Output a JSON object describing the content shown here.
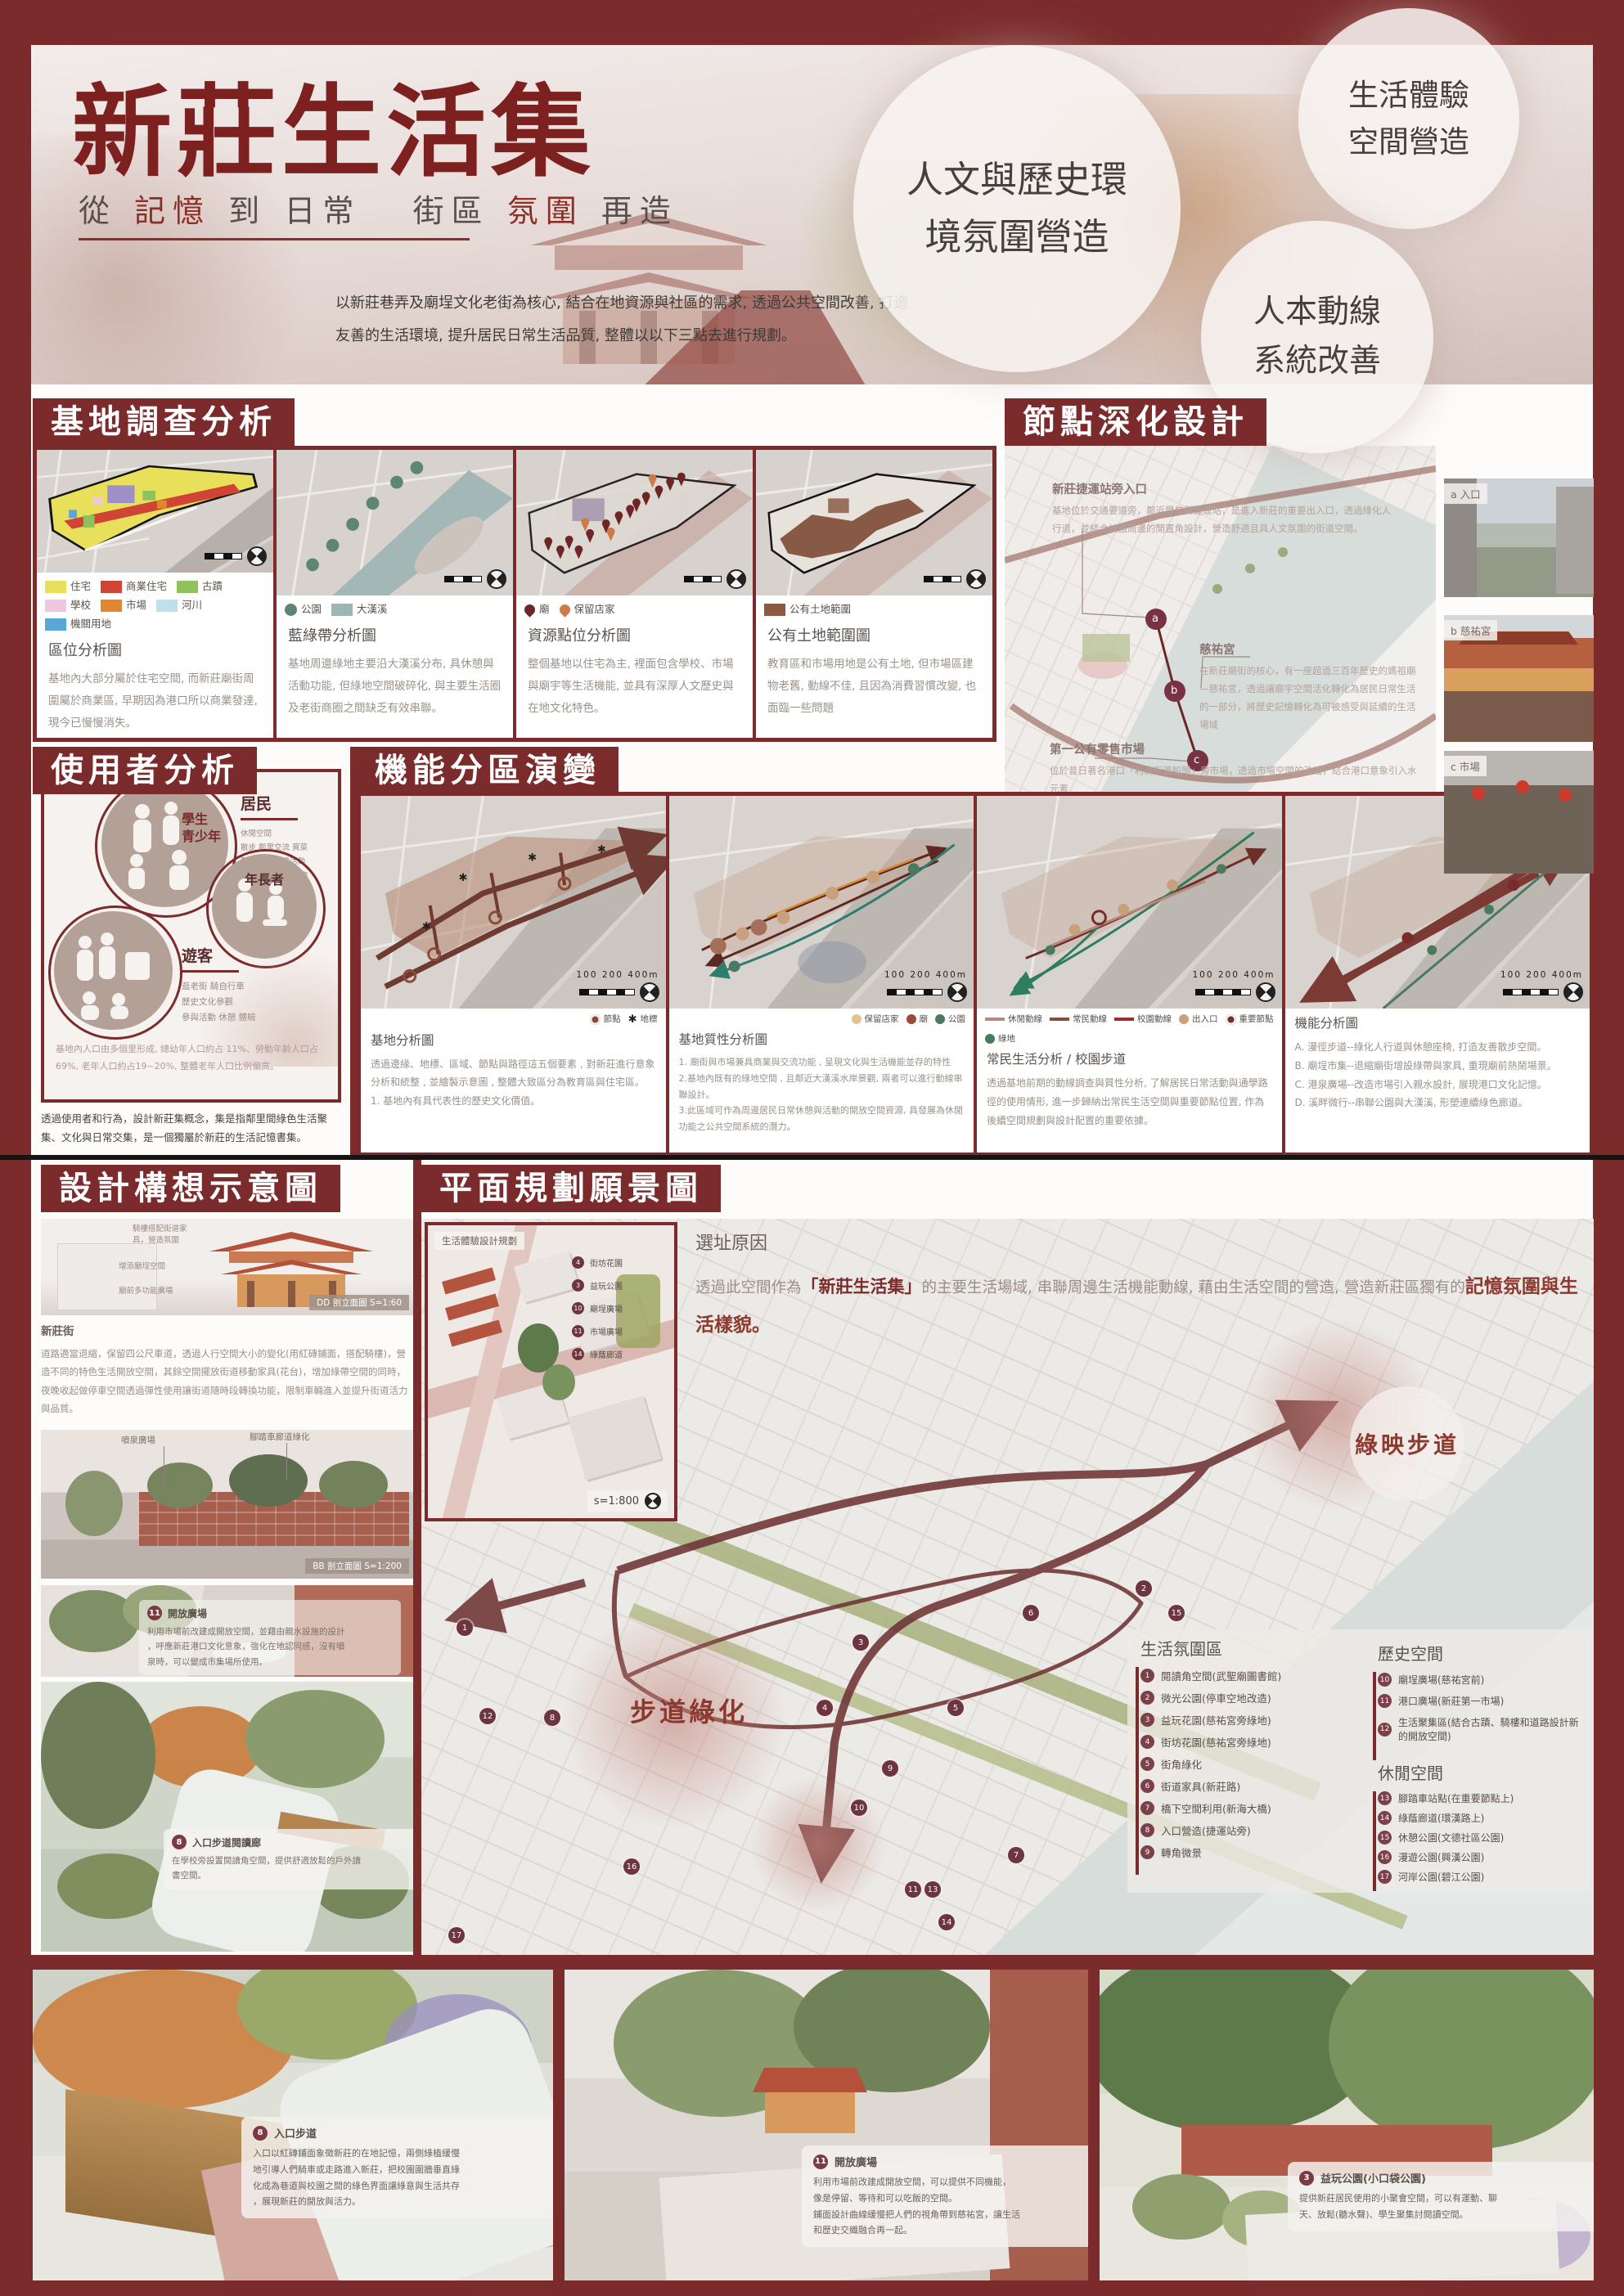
{
  "colors": {
    "frame_maroon": "#7b2b2b",
    "title_red": "#7c2020",
    "accent_red": "#8c3a30"
  },
  "header": {
    "title": "新莊生活集",
    "subtitle": {
      "p0": "從",
      "p1": "記憶",
      "p2": "到",
      "p3": "日常",
      "p4": "街區",
      "p5": "氛圍",
      "p6": "再造"
    },
    "intro": "以新莊巷弄及廟埕文化老街為核心, 結合在地資源與社區的需求, 透過公共空間改善, 打造\n友善的生活環境, 提升居民日常生活品質, 整體以以下三點去進行規劃。",
    "badges": {
      "b1": "人文與歷史環\n境氛圍營造",
      "b2": "生活體驗\n空間營造",
      "b3": "人本動線\n系統改善"
    }
  },
  "site_survey": {
    "title": "基地調查分析",
    "maps": [
      {
        "name": "區位分析圖",
        "caption": "基地內大部分屬於住宅空間, 而新莊廟街周圍屬於商業區, 早期因為港口所以商業發達, 現今已慢慢消失。",
        "legend": [
          {
            "label": "住宅",
            "color": "#e8e05a"
          },
          {
            "label": "商業住宅",
            "color": "#cf4434"
          },
          {
            "label": "古蹟",
            "color": "#8fc25c"
          },
          {
            "label": "學校",
            "color": "#ecc7de"
          },
          {
            "label": "市場",
            "color": "#e2862f"
          },
          {
            "label": "河川",
            "color": "#bfe0e8"
          },
          {
            "label": "機關用地",
            "color": "#57a8d8"
          }
        ]
      },
      {
        "name": "藍綠帶分析圖",
        "caption": "基地周邊綠地主要沿大漢溪分布, 具休憩與活動功能, 但綠地空間破碎化, 與主要生活圈及老街商圈之間缺乏有效串聯。",
        "legend": [
          {
            "label": "公園",
            "color": "#5e8672"
          },
          {
            "label": "大漢溪",
            "color": "#9fb5b3"
          }
        ]
      },
      {
        "name": "資源點位分析圖",
        "caption": "整個基地以住宅為主, 裡面包含學校、市場與廟宇等生活機能, 並具有深厚人文歷史與在地文化特色。",
        "legend": [
          {
            "label": "廟",
            "color": "#6e2525"
          },
          {
            "label": "保留店家",
            "color": "#cf7a4a"
          }
        ]
      },
      {
        "name": "公有土地範圍圖",
        "caption": "教育區和市場用地是公有土地, 但市場區建物老舊, 動線不佳, 且因為消費習慣改變, 也面臨一些問題",
        "legend": [
          {
            "label": "公有土地範圍",
            "color": "#8a5a41"
          }
        ]
      }
    ]
  },
  "node_design": {
    "title": "節點深化設計",
    "annotations": [
      {
        "heading": "新莊捷運站旁入口",
        "body": "基地位於交通要道旁，鄰近學校與捷運站，是進入新莊的重要出入口，透過綠化人\n行道，並結合校園周邊的閒置角設計，營造舒適且具人文氛圍的街道空間。"
      },
      {
        "heading": "慈祐宮",
        "body": "在新莊廟街的核心，有一座超過三百年歷史的媽祖廟—慈祐宮，透過讓廟宇空間活化轉化為居民日常生活的一部分，將歷史記憶轉化為可被感受與延續的生活場域"
      },
      {
        "heading": "第一公有零售市場",
        "body": "位於昔日著名港口「利濟街渡船頭」旁市場，透過市場空間的改造，結合港口意象引入水元素\n設計親水階梯，使廟前至市場廣場之間形成一個連續的生活聚集軸帶。"
      }
    ],
    "route_nodes": [
      "a",
      "b",
      "c"
    ],
    "photos": [
      {
        "label": "a 入口"
      },
      {
        "label": "b 慈祐宮"
      },
      {
        "label": "c 市場"
      }
    ]
  },
  "user_analysis": {
    "title": "使用者分析",
    "resident": {
      "name": "居民",
      "lines": "休閒空間\n散步 鄰里交流 買菜\n聚集空間 日常活動\n休憩 騎腳踏車 購物\n在地回憶"
    },
    "students": "學生\n青少年",
    "elder": "年長者",
    "visitor": {
      "name": "遊客",
      "lines": "逛老街 騎自行車\n歷史文化參觀\n參與活動 休憩 體驗"
    },
    "stats": "基地內人口由多個里形成, 總幼年人口約占 11%、勞動年齡人口占69%, 老年人口約占19~20%, 整體老年人口比例偏高。",
    "concept": "透過使用者和行為，設計新莊集概念，集是指鄰里間綠色生活聚集、文化與日常交集，是一個獨屬於新莊的生活記憶書集。"
  },
  "zoning": {
    "title": "機能分區演變",
    "maps": [
      {
        "name": "基地分析圖",
        "scale": "100  200      400m",
        "caption": "透過邊緣、地標、區域、節點與路徑這五個要素 , 對新莊進行意象分析和統整 , 並繪製示意圖 , 整體大致區分為教育區與住宅區。\n1. 基地內有具代表性的歷史文化價值。",
        "legend": [
          {
            "label": "節點",
            "type": "ring",
            "color": "#8a4a3a"
          },
          {
            "label": "地標",
            "type": "star",
            "color": "#222222"
          }
        ]
      },
      {
        "name": "基地質性分析圖",
        "scale": "100  200      400m",
        "caption": "1. 廟街與市場兼具商業與交流功能 , 呈現文化與生活機能並存的特性\n2.基地內既有的綠地空間 , 且鄰近大漢溪水岸景觀, 兩者可以進行動線串聯設計。\n3.此區域可作為周邊居民日常休憩與活動的開放空間資源, 具發展為休閒功能之公共空間系統的潛力。",
        "legend": [
          {
            "label": "保留店家",
            "type": "dot",
            "color": "#e3c48e"
          },
          {
            "label": "廟",
            "type": "dot",
            "color": "#9c4a3a"
          },
          {
            "label": "公園",
            "type": "dot",
            "color": "#4a7a5e"
          }
        ]
      },
      {
        "name": "常民生活分析 / 校園步道",
        "scale": "100  200      400m",
        "caption": "透過基地前期的動線調查與質性分析, 了解居民日常活動與通學路徑的使用情形, 進一步歸納出常民生活空間與重要節點位置, 作為後續空間規劃與設計配置的重要依據。",
        "legend": [
          {
            "label": "休閒動線",
            "type": "line",
            "color": "#b58a7a"
          },
          {
            "label": "常民動線",
            "type": "line",
            "color": "#8a4a3a"
          },
          {
            "label": "校園動線",
            "type": "line",
            "color": "#9c2f2a"
          },
          {
            "label": "出入口",
            "type": "dot",
            "color": "#c8a07e"
          },
          {
            "label": "重要節點",
            "type": "ring",
            "color": "#7b2b2b"
          },
          {
            "label": "綠地",
            "type": "dot",
            "color": "#4a7a5e"
          }
        ]
      },
      {
        "name": "機能分析圖",
        "scale": "100  200      400m",
        "caption": "A. 漫徑步道--綠化人行道與休憩座椅, 打造友善散步空間。\nB. 廟埕市集--退縮廟街增設綠帶與家具, 重現廟前熱鬧場景。\nC. 港泉廣場--改造市場引入親水設計, 展現港口文化記憶。\nD. 溪畔微行--串聯公園與大漢溪, 形塑連續綠色廊道。",
        "legend": []
      }
    ]
  },
  "design_concepts": {
    "title": "設計構想示意圖",
    "elevation": {
      "ann1": "騎樓搭配街道家\n具，營造氛圍",
      "ann2": "增添廟埕空間",
      "ann3": "廟前多功能廣場",
      "tag": "DD 剖立面圖 S=1:60"
    },
    "street": {
      "heading": "新莊街",
      "body": "道路適當退縮，保留四公尺車道，透過人行空間大小的變化(用紅磚鋪面，搭配騎樓)，營造不同的特色生活開放空間，其餘空間擺放街道移動家具(花台)，增加綠帶空間的同時，夜晚收起做停車空間透過彈性使用讓街道隨時段轉換功能，限制車輛進入並提升街道活力與品質。"
    },
    "section_bb": {
      "ann1": "噴泉廣場",
      "ann2": "腳踏車廊道綠化",
      "tag": "BB 剖立面圖 S=1:200"
    },
    "plaza": {
      "num": "11",
      "heading": "開放廣場",
      "body": "利用市場前改建成開放空間，並藉由親水設施的設計\n，呼應新莊港口文化意象，強化在地認同感，沒有噴\n泉時，可以變成市集場所使用。"
    },
    "entry": {
      "num": "8",
      "heading": "入口步道閱讀廊",
      "body": "在學校旁設置閱讀角空間，提供舒適放鬆的戶外讀\n書空間。"
    }
  },
  "master_plan": {
    "title": "平面規劃願景圖",
    "inset": {
      "title": "生活體驗設計規劃",
      "scale": "s=1:800",
      "items": [
        {
          "num": "4",
          "label": "街坊花園"
        },
        {
          "num": "3",
          "label": "益玩公園"
        },
        {
          "num": "10",
          "label": "廟埕廣場"
        },
        {
          "num": "11",
          "label": "市場廣場"
        },
        {
          "num": "14",
          "label": "綠蔭廊道"
        }
      ]
    },
    "reason": {
      "title": "選址原因",
      "seg1": "透過此空間作為",
      "brand": "「新莊生活集」",
      "seg2": "的主要生活場域, 串聯周邊生活機能動線, 藉由生活空間的營造, 營造新莊區獨有的",
      "strong": "記憶氛圍與生活樣貌。"
    },
    "labels": {
      "walkway": "步道綠化",
      "greenway": "綠映步道"
    },
    "legend": {
      "life": {
        "title": "生活氛圍區",
        "items": [
          {
            "num": "1",
            "label": "閱讀角空間(武聖廟圖書館)"
          },
          {
            "num": "2",
            "label": "微光公園(停車空地改造)"
          },
          {
            "num": "3",
            "label": "益玩花園(慈祐宮旁綠地)"
          },
          {
            "num": "4",
            "label": "街坊花園(慈祐宮旁綠地)"
          },
          {
            "num": "5",
            "label": "街角綠化"
          },
          {
            "num": "6",
            "label": "街道家具(新莊路)"
          },
          {
            "num": "7",
            "label": "橋下空間利用(新海大橋)"
          },
          {
            "num": "8",
            "label": "入口營造(捷運站旁)"
          },
          {
            "num": "9",
            "label": "轉角微景"
          }
        ]
      },
      "history": {
        "title": "歷史空間",
        "items": [
          {
            "num": "10",
            "label": "廟埕廣場(慈祐宮前)"
          },
          {
            "num": "11",
            "label": "港口廣場(新莊第一市場)"
          },
          {
            "num": "12",
            "label": "生活聚集區(結合古蹟、騎樓和道路設計新的開放空間)"
          }
        ]
      },
      "leisure": {
        "title": "休閒空間",
        "items": [
          {
            "num": "13",
            "label": "腳踏車站點(在重要節點上)"
          },
          {
            "num": "14",
            "label": "綠蔭廊道(環漢路上)"
          },
          {
            "num": "15",
            "label": "休憩公園(文德社區公園)"
          },
          {
            "num": "16",
            "label": "漫遊公園(興漢公園)"
          },
          {
            "num": "17",
            "label": "河岸公園(碧江公園)"
          }
        ]
      }
    }
  },
  "bottom": [
    {
      "num": "8",
      "heading": "入口步道",
      "body": "入口以紅磚鋪面象徵新莊的在地記憶，兩側綠植緩慢\n地引導人們騎車或走路進入新莊，把校園圍牆垂直綠\n化成為巷道與校園之間的綠色界面讓綠意與生活共存\n，展現新莊的開放與活力。"
    },
    {
      "num": "11",
      "heading": "開放廣場",
      "body": "利用市場前改建成開放空間，可以提供不同機能，\n像是停留、等待和可以吃飯的空間。\n鋪面設計曲線緩慢把人們的視角帶到慈祐宮，讓生活\n和歷史交織融合再一起。"
    },
    {
      "num": "3",
      "heading": "益玩公園(小口袋公園)",
      "body": "提供新莊居民使用的小聚會空間，可以有運動、聊\n天、放鬆(聽水聲)、學生聚集討閱讀空間。"
    }
  ]
}
